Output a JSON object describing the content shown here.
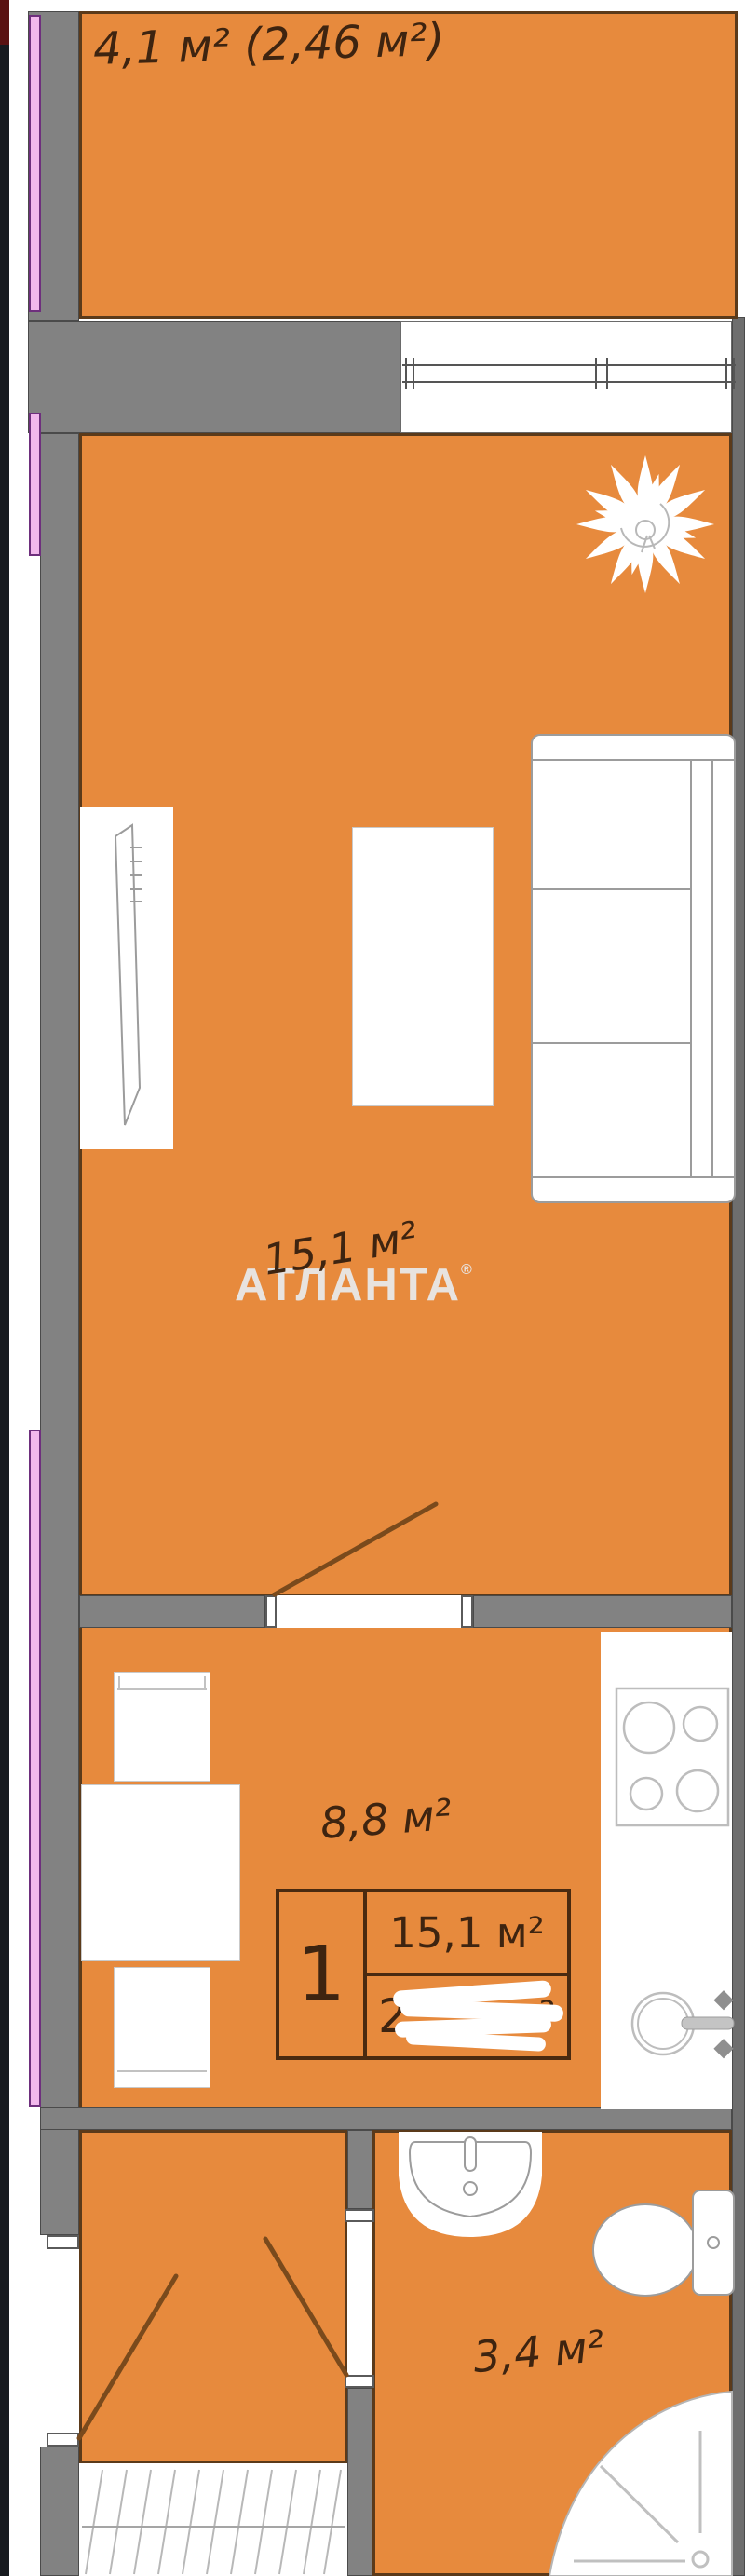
{
  "plan": {
    "watermark": {
      "text": "АТЛАНТА",
      "mark": "®"
    },
    "rooms": {
      "balcony": {
        "label": "4,1 м² (2,46 м²)"
      },
      "living": {
        "label": "15,1 м²"
      },
      "kitchen": {
        "label": "8,8 м²"
      },
      "bathroom": {
        "label": "3,4 м²"
      }
    },
    "info_table": {
      "rooms_count": "1",
      "living_area": "15,1 м²",
      "total_area_prefix": "2",
      "total_area_unit": "м²"
    },
    "colors": {
      "room-fill": "#E78A3D",
      "wall-gray": "#828282",
      "right-wall": "#6E6E6E",
      "window-pink": "#F2B8EC",
      "window-frame": "#6E2F7D",
      "ink": "#3E2410",
      "door-line": "#7A4A1C",
      "furn-outline": "#9C9C9C",
      "room-border": "#5B3A1A",
      "watermark": "#E9EAEC"
    }
  }
}
